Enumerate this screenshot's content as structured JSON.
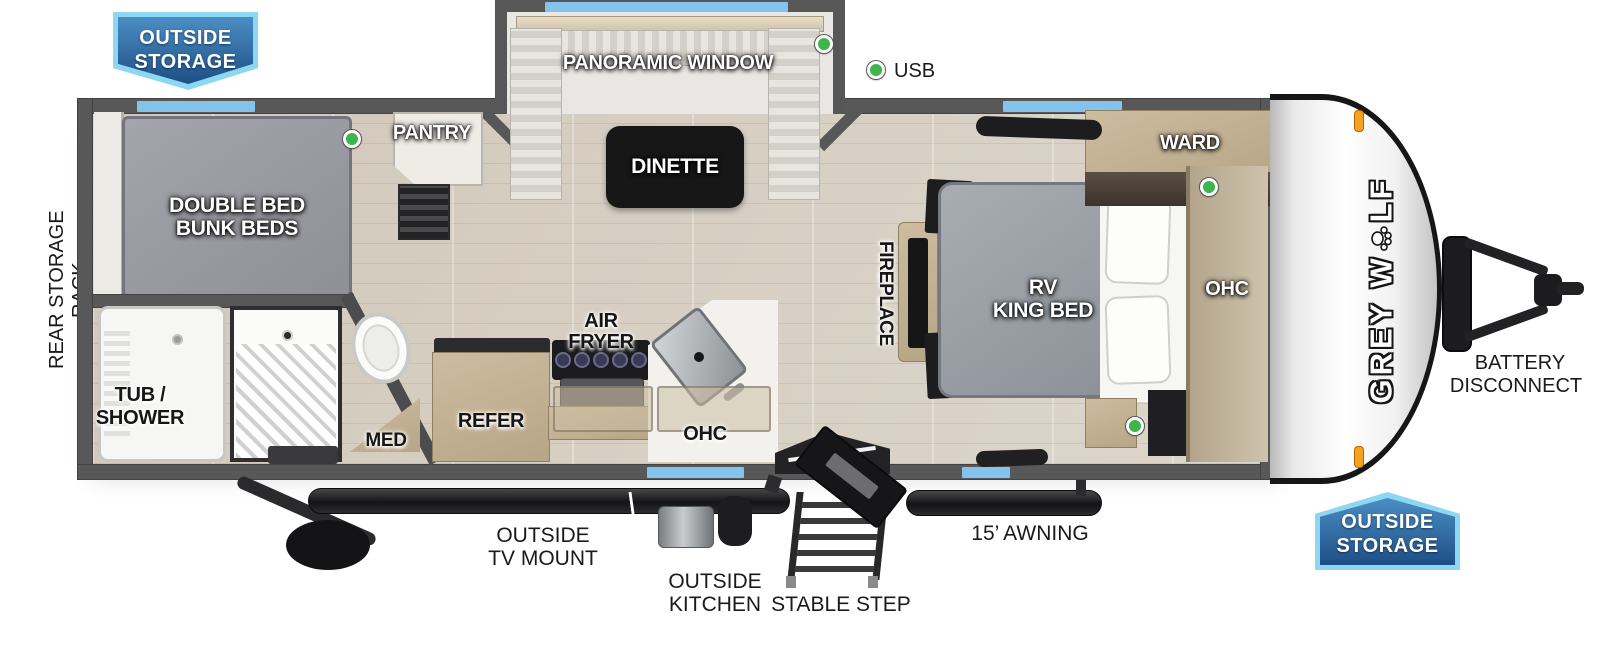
{
  "brand": {
    "full_name": "GREY WOLF",
    "logo_left": "GREY W",
    "logo_right": "LF"
  },
  "callouts": {
    "outside_storage": {
      "line1": "OUTSIDE",
      "line2": "STORAGE"
    },
    "rear_storage_rack": "REAR STORAGE RACK",
    "usb": "USB",
    "battery": {
      "line1": "BATTERY",
      "line2": "DISCONNECT"
    },
    "tv_mount": {
      "line1": "OUTSIDE",
      "line2": "TV MOUNT"
    },
    "outside_kitchen": {
      "line1": "OUTSIDE",
      "line2": "KITCHEN"
    },
    "stable_step": "STABLE STEP",
    "awning": "15’ AWNING"
  },
  "rooms": {
    "bunk": {
      "line1": "DOUBLE BED",
      "line2": "BUNK BEDS"
    },
    "bath": {
      "tub_line1": "TUB /",
      "tub_line2": "SHOWER",
      "med": "MED"
    },
    "kitchen": {
      "pantry": "PANTRY",
      "refer": "REFER",
      "air_line1": "AIR",
      "air_line2": "FRYER",
      "ohc": "OHC"
    },
    "dinette": {
      "table": "DINETTE",
      "window": "PANORAMIC WINDOW"
    },
    "bedroom": {
      "bed_line1": "RV",
      "bed_line2": "KING BED",
      "ward": "WARD",
      "ohc": "OHC",
      "fireplace": "FIREPLACE"
    }
  },
  "icons": {
    "indicator": "led-indicator-icon",
    "paw": "paw-print-icon",
    "marker_light": "marker-light-icon"
  },
  "colors": {
    "badge_border": "#8ed7f2",
    "badge_fill_top": "#4b8ec3",
    "badge_fill_bottom": "#1d4f86",
    "window_blue": "#85c3ec",
    "indicator_green": "#3cb54a",
    "marker_orange": "#f6a21e",
    "wall_gray": "#585858"
  }
}
